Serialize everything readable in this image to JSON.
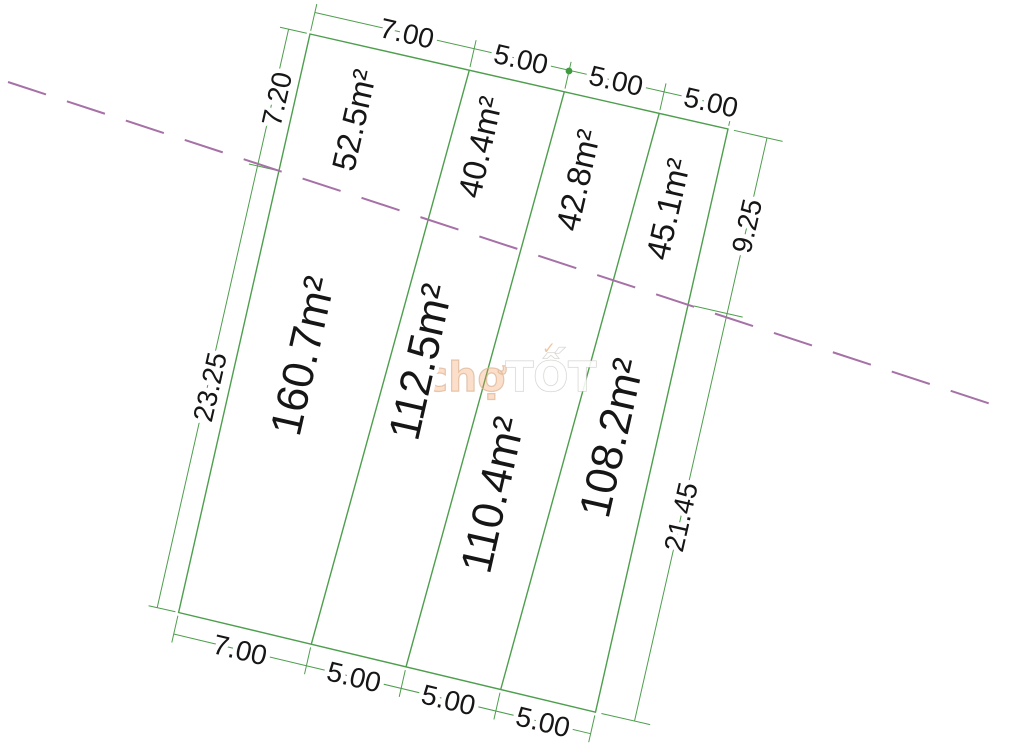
{
  "diagram": {
    "title": "Land subdivision survey sketch",
    "watermark": {
      "prefix": "chợ",
      "suffix": "TỐT",
      "check_icon": "✓"
    },
    "colors": {
      "line_green": "#4d9e4d",
      "planning_line_magenta": "#a671a6",
      "label_text": "#161616",
      "marker_green": "#3f9b3f",
      "background": "#ffffff"
    },
    "plots_upper": [
      {
        "area": "52.5m²"
      },
      {
        "area": "40.4m²"
      },
      {
        "area": "42.8m²"
      },
      {
        "area": "45.1m²"
      }
    ],
    "plots_lower": [
      {
        "area": "160.7m²"
      },
      {
        "area": "112.5m²"
      },
      {
        "area": "110.4m²"
      },
      {
        "area": "108.2m²"
      }
    ],
    "dimensions": {
      "top": [
        "7.00",
        "5.00",
        "5.00",
        "5.00"
      ],
      "bottom": [
        "7.00",
        "5.00",
        "5.00",
        "5.00"
      ],
      "left": [
        "7.20",
        "23.25"
      ],
      "right": [
        "9.25",
        "21.45"
      ]
    }
  }
}
